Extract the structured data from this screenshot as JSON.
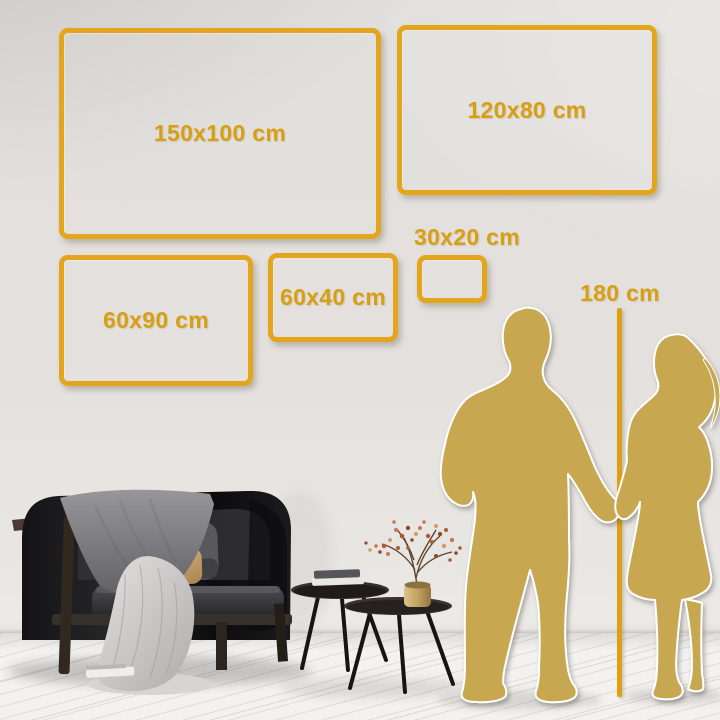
{
  "size_guide": {
    "frames": [
      {
        "label": "150x100 cm"
      },
      {
        "label": "120x80 cm"
      },
      {
        "label": "60x90 cm"
      },
      {
        "label": "60x40 cm"
      },
      {
        "label": "30x20 cm"
      }
    ],
    "ruler": {
      "label": "180 cm"
    }
  },
  "colors": {
    "accent_gold": "#e2a51b",
    "label_gold": "#d89f15",
    "silhouette_gold": "#c8a751",
    "wall": "#e3e0dd",
    "floor": "#f3f2f0"
  },
  "scene": {
    "items": [
      "sofa",
      "gray-blanket",
      "white-blanket",
      "pillows",
      "nesting-coffee-tables",
      "books",
      "brass-vase-with-dried-branches",
      "man-silhouette",
      "woman-silhouette",
      "height-ruler"
    ]
  }
}
